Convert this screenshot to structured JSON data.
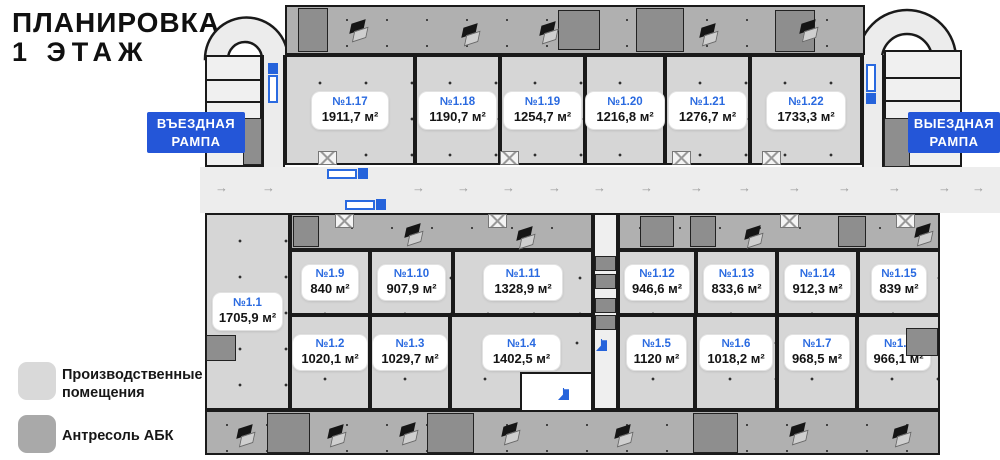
{
  "title": {
    "line1": "ПЛАНИРОВКА",
    "line2": "1 ЭТАЖ"
  },
  "ramp_labels": {
    "entry_line1": "ВЪЕЗДНАЯ",
    "entry_line2": "РАМПА",
    "exit_line1": "ВЫЕЗДНАЯ",
    "exit_line2": "РАМПА"
  },
  "legend": {
    "production": {
      "label": "Производственные помещения",
      "color": "#d9d9d9"
    },
    "mezzanine": {
      "label": "Антресоль АБК",
      "color": "#a9a9a9"
    }
  },
  "colors": {
    "accent_blue": "#2456d8",
    "unit_number_blue": "#2a6ae0",
    "production_fill": "#d6d6d6",
    "mezzanine_fill": "#b0b0b0",
    "road_fill": "#ededed"
  },
  "units": {
    "u1": {
      "number": "№1.1",
      "area": "1705,9 м²"
    },
    "u2": {
      "number": "№1.2",
      "area": "1020,1 м²"
    },
    "u3": {
      "number": "№1.3",
      "area": "1029,7 м²"
    },
    "u4": {
      "number": "№1.4",
      "area": "1402,5 м²"
    },
    "u5": {
      "number": "№1.5",
      "area": "1120 м²"
    },
    "u6": {
      "number": "№1.6",
      "area": "1018,2 м²"
    },
    "u7": {
      "number": "№1.7",
      "area": "968,5 м²"
    },
    "u8": {
      "number": "№1.8",
      "area": "966,1 м²"
    },
    "u9": {
      "number": "№1.9",
      "area": "840 м²"
    },
    "u10": {
      "number": "№1.10",
      "area": "907,9 м²"
    },
    "u11": {
      "number": "№1.11",
      "area": "1328,9 м²"
    },
    "u12": {
      "number": "№1.12",
      "area": "946,6 м²"
    },
    "u13": {
      "number": "№1.13",
      "area": "833,6 м²"
    },
    "u14": {
      "number": "№1.14",
      "area": "912,3 м²"
    },
    "u15": {
      "number": "№1.15",
      "area": "839 м²"
    },
    "u17": {
      "number": "№1.17",
      "area": "1911,7 м²"
    },
    "u18": {
      "number": "№1.18",
      "area": "1190,7 м²"
    },
    "u19": {
      "number": "№1.19",
      "area": "1254,7 м²"
    },
    "u20": {
      "number": "№1.20",
      "area": "1216,8 м²"
    },
    "u21": {
      "number": "№1.21",
      "area": "1276,7 м²"
    },
    "u22": {
      "number": "№1.22",
      "area": "1733,3 м²"
    }
  }
}
